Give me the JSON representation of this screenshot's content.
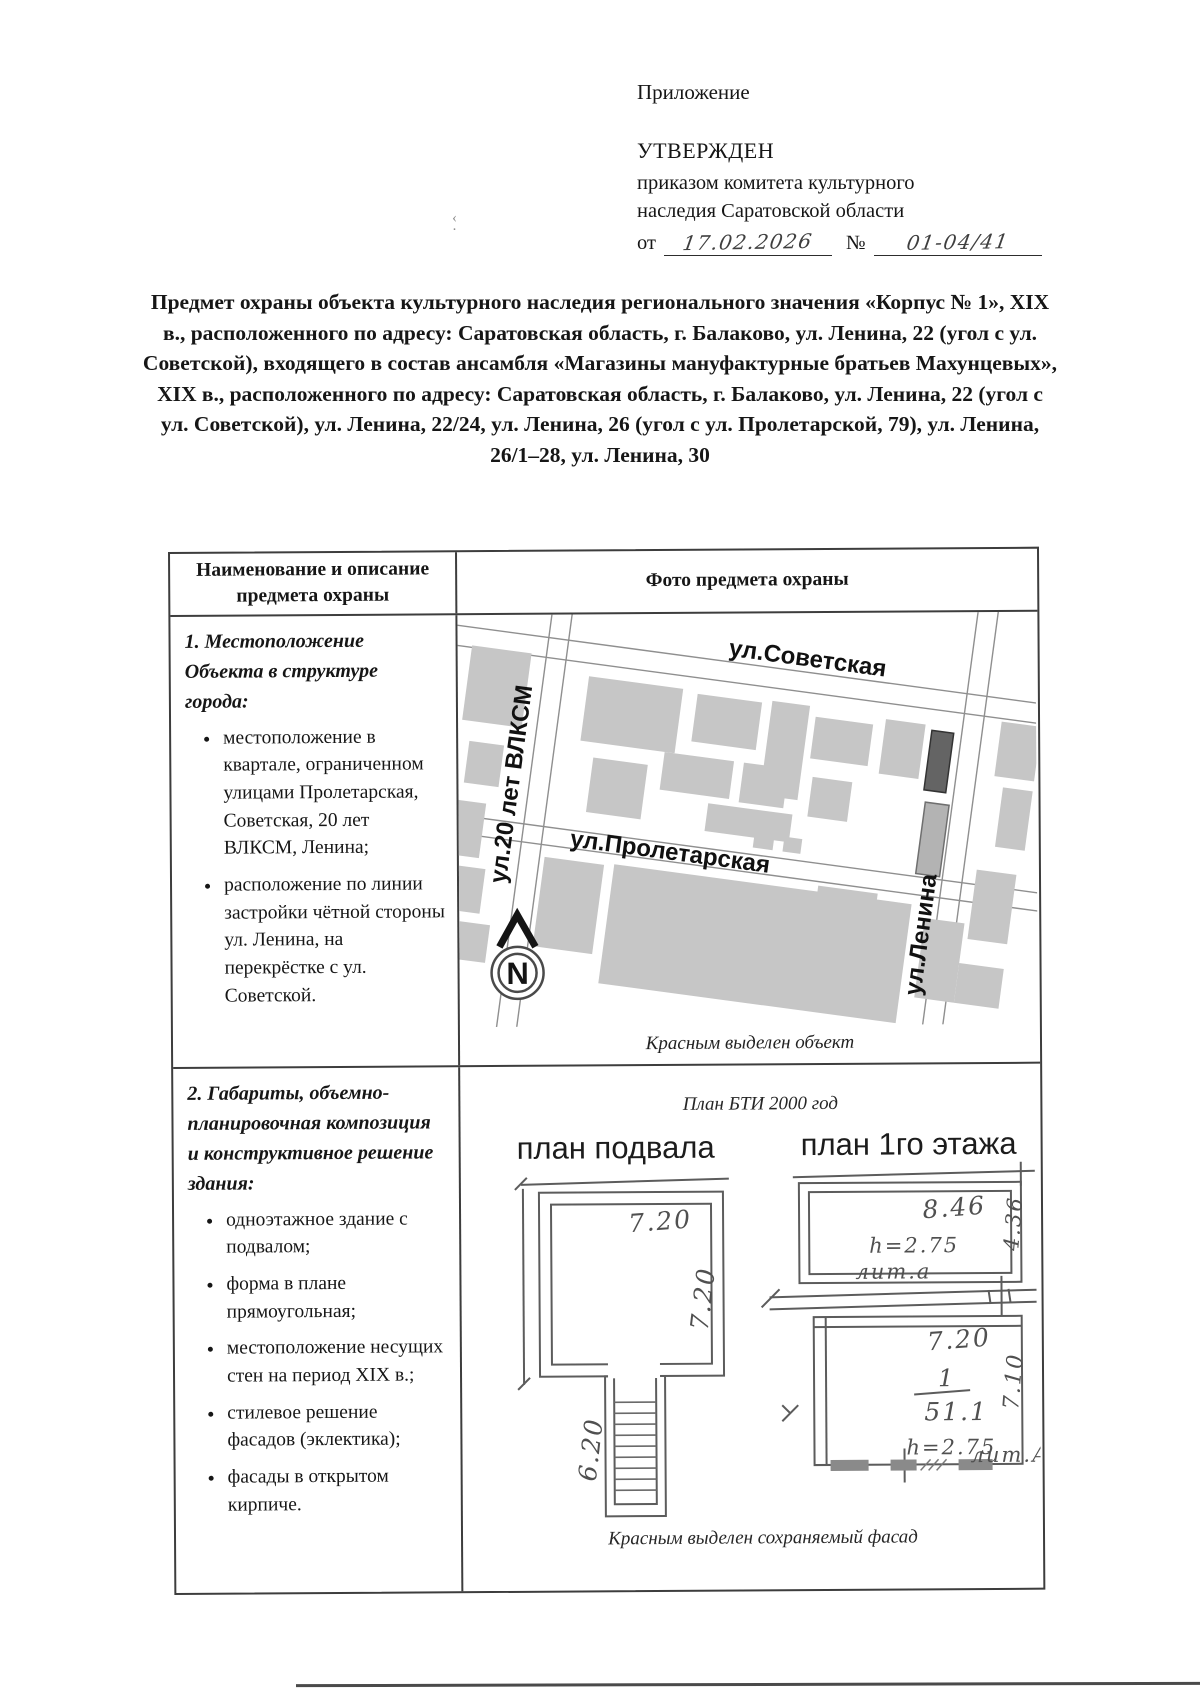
{
  "header": {
    "annex_label": "Приложение",
    "approved": "УТВЕРЖДЕН",
    "by_line1": "приказом комитета культурного",
    "by_line2": "наследия Саратовской области",
    "from_label": "от",
    "date_value": "17.02.2026",
    "number_sign": "№",
    "number_value": "01-04/41"
  },
  "title": "Предмет охраны объекта культурного наследия регионального значения «Корпус № 1», XIX в., расположенного по адресу: Саратовская область, г. Балаково, ул. Ленина, 22 (угол с ул. Советской), входящего в состав ансамбля «Магазины мануфактурные братьев Махунцевых», XIX в., расположенного по адресу: Саратовская область, г. Балаково, ул. Ленина, 22 (угол с ул. Советской), ул. Ленина, 22/24, ул. Ленина, 26 (угол с ул. Пролетарской, 79), ул. Ленина, 26/1–28, ул. Ленина, 30",
  "table": {
    "headers": [
      "Наименование и описание предмета охраны",
      "Фото предмета охраны"
    ],
    "row1": {
      "heading": "1. Местоположение Объекта в структуре города:",
      "bullets": [
        "местоположение в квартале, ограниченном улицами Пролетарская, Советская, 20 лет ВЛКСМ, Ленина;",
        "расположение по линии застройки чётной стороны ул. Ленина, на перекрёстке с ул. Советской."
      ],
      "map": {
        "street_sovetskaya": "ул.Советская",
        "street_proletarskaya": "ул.Пролетарская",
        "street_vlksm": "ул.20 лет ВЛКСМ",
        "street_lenina": "ул.Ленина",
        "north_label": "N",
        "caption": "Красным выделен объект"
      }
    },
    "row2": {
      "heading": "2. Габариты, объемно-планировочная композиция и конструктивное решение здания:",
      "bullets": [
        "одноэтажное здание с подвалом;",
        "форма в плане прямоугольная;",
        "местоположение несущих стен на период XIX в.;",
        "стилевое решение фасадов (эклектика);",
        "фасады в открытом кирпиче."
      ],
      "plans": {
        "source_caption": "План БТИ 2000 год",
        "basement_title": "план подвала",
        "floor_title": "план 1го этажа",
        "basement_width": "7.20",
        "basement_depth": "7.20",
        "basement_stairs": "6.20",
        "litera_a_width": "8.46",
        "litera_a_height": "h=2.75",
        "litera_a_label": "лит.а",
        "litera_a_depth": "4.36",
        "litera_A_width": "7.20",
        "litera_A_room_number": "1",
        "litera_A_area": "51.1",
        "litera_A_depth": "7.10",
        "litera_A_height": "h=2.75",
        "litera_A_label": "лит.А",
        "caption": "Красным выделен сохраняемый фасад"
      }
    }
  }
}
